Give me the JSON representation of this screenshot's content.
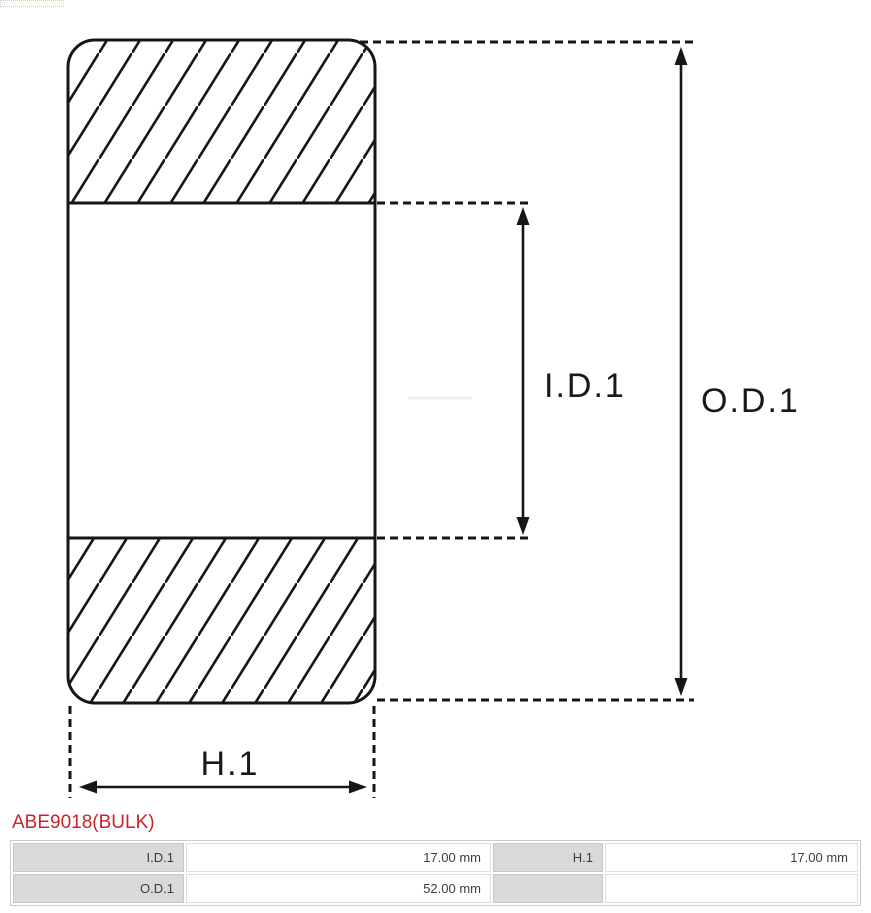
{
  "part": {
    "title": "ABE9018(BULK)"
  },
  "diagram": {
    "type": "bearing-cross-section",
    "labels": {
      "inner_diameter": "I.D.1",
      "outer_diameter": "O.D.1",
      "height": "H.1"
    }
  },
  "spec_table": {
    "rows": [
      {
        "cells": [
          {
            "label": "I.D.1",
            "value": "17.00 mm"
          },
          {
            "label": "H.1",
            "value": "17.00 mm"
          }
        ]
      },
      {
        "cells": [
          {
            "label": "O.D.1",
            "value": "52.00 mm"
          },
          {
            "label": "",
            "value": ""
          }
        ]
      }
    ]
  },
  "colors": {
    "accent_red": "#c9232b",
    "diagram_stroke": "#161616",
    "table_label_bg": "#d9d9d9",
    "table_border": "#cccccc"
  }
}
